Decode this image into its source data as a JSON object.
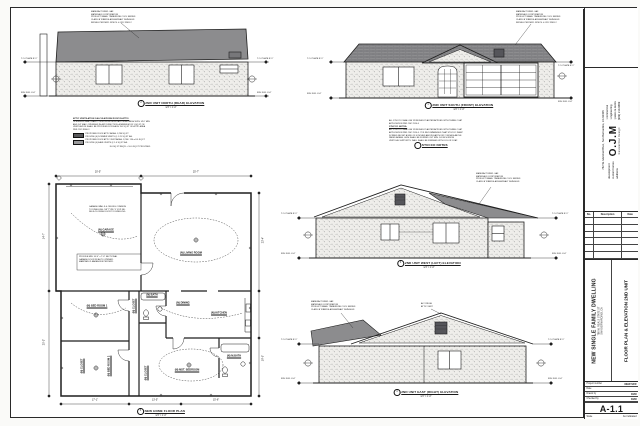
{
  "page": {
    "ink": "#1f1f1f",
    "roof_gray": "#8c8c8e",
    "vent_dark": "#55555a"
  },
  "titleblock": {
    "company": {
      "address_line": "782 W. Marshall Blvd., San Bernardino, CA 92405",
      "dev1": "development",
      "dev2": "custom homes",
      "dev3": "additions",
      "logo": "O.J.M",
      "logo_sub": "Residential Design",
      "svc1": ": commercial",
      "svc2": ": engineering",
      "svc3": ": patios & decks",
      "phone": "(909) 210-9669"
    },
    "revisions": {
      "no": "No.",
      "description": "Description",
      "date": "Date"
    },
    "project": {
      "title": "NEW SINGLE FAMILY DWELLING",
      "addr1": "786 W. REALS STATE ST",
      "addr2": "SAN BERNARDINO, CA",
      "sheet_title": "FLOOR PLAN & ELEVATION 2ND UNIT"
    },
    "fields": {
      "pn_label": "Project number",
      "pn_value": "NEW SFR",
      "date_label": "Date",
      "date_value": "",
      "drawn_label": "Drawn by",
      "drawn_value": "OJM",
      "checked_label": "Checked by",
      "checked_value": "OJM",
      "sheet_number": "A-1.1",
      "scale_label": "Scale",
      "scale_value": "As indicated"
    }
  },
  "callouts": {
    "front": {
      "num": "1",
      "title": "2ND UNIT SOUTH (FRONT) ELEVATION",
      "scale": "1/4\" = 1'-0\""
    },
    "north": {
      "num": "2",
      "title": "2ND UNIT NORTH (REAR) ELEVATION",
      "scale": "1/4\" = 1'-0\""
    },
    "west": {
      "num": "3",
      "title": "2ND UNIT WEST (LEFT) ELEVATION",
      "scale": "1/4\" = 1'-0\""
    },
    "east": {
      "num": "4",
      "title": "2ND UNIT EAST (RIGHT) ELEVATION",
      "scale": "1/4\" = 1'-0\""
    },
    "plan": {
      "num": "5",
      "title": "NEW HOME FLOOR PLAN",
      "scale": "1/4\" = 1'-0\""
    }
  },
  "elev_marks": {
    "top_plate": "T.O. PLATE 8'-1\"",
    "floor": "FIN. FLR. 0'-0\""
  },
  "rooms": {
    "garage": "(N) GARAGE",
    "living": "(N) LIVING ROOM",
    "dining": "(N) DINING",
    "kitchen": "(N) KITCHEN",
    "bath": "(N) BATH",
    "closet": "(N) CLOSET",
    "bed1": "(N) BED ROOM 1",
    "bed2": "(N) BED ROOM 2",
    "master": "(N) MST. BEDROOM",
    "mbath": "(N) M.BATH"
  },
  "plan_dims": {
    "top1": "20'-5\"",
    "top2": "25'-7\"",
    "left1": "14'-7\"",
    "left2": "25'-3\"",
    "bottom1": "17'-1\"",
    "bottom2": "13'-5\"",
    "bottom3": "15'-6\"",
    "right1": "23'-4\"",
    "right2": "19'-5\""
  },
  "notes": {
    "mfr": {
      "l1": "MANUFACTURER: GAF",
      "l2": "MATERIALS CORPORATION",
      "l3": "PRODUCT NAME: TIMBERLINE COOL SERIES",
      "l4": "CLASS 'A' FIBERGLASS ASPHALT SHINGLES",
      "l5": "INSTALL PER MFR. SPECS. & CRC R905.2"
    },
    "attic": {
      "title": "ATTIC VENTILATION CALCULATIONS ROOF IN ATTIC:",
      "l1": "OPENINGS SHALL HAVE CORROSION RESISTANT WIRE MESH WITH 1/16\" MIN.",
      "l2": "AND 1/4\" MAX. OPENINGS IN ANY DIRECTION. A MINIMUM OF 1 SQ FT OF",
      "l3": "VENTILATION SHALL BE PROVIDED FOR EACH 150 SQ FT OF ATTIC AREA",
      "l4": "PER CRC R806.2.",
      "leg1a": "PROPOSED ROOF ATTIC AREA: 1,290 SQ FT",
      "leg1b": "PROVIDE (6) DORMER VENTS @ 1.25 SQ FT EA.",
      "leg2a": "PROPOSED ROOF ATTIC VENT AREA: 1,290 / 150 = 8.6 SQ FT",
      "leg2b": "PROVIDE (4) EAVE VENTS @ 1.0 SQ FT EA.",
      "footer": "8.6 SQ FT REQ'D < 10.0 SQ FT PROVIDED"
    },
    "stucco": {
      "i1": "ALL STUCCO SHALL BE 7/8 INCHES PLASTER APPLIED WITH THREE COAT",
      "i2": "APPLICATION PER CBC 2510.6",
      "head": "STUCCO NOTES:",
      "l1": "ALL STUCCO SHALL BE 7/8 INCHES PLASTER APPLIED WITH THREE COAT",
      "l2": "APPLICATION PER CBC 2510.6. IT IS RECOMMENDED THAT STUCCO WEEP",
      "l3": "SCREED BE SET A MIN. OF 4 INCHES ABOVE EARTH OR 2 INCHES ABOVE",
      "l4": "PAVED AREAS. LATH SHALL BE FURRED OUT MIN. 1/4 INCH FROM",
      "l5": "VERTICAL SUPPORTS. WALL SHALL BE FINISHED WITH COLOR COAT.",
      "callout": "STUCCO NOTES"
    },
    "garage_box": {
      "l1": "PROVIDE MIN. 16'-0\" x 7'-0\" SECTIONAL",
      "l2": "GARAGE DOOR W/ AUTO OPENER.",
      "l3": "MAINTAIN CLEARANCES PER MFR."
    },
    "garage2": {
      "l1": "GARAGE WALLS & CEILING COMMON",
      "l2": "TO DWELLING: 5/8\" TYPE 'X' GYP. BD.",
      "l3": "SELF-CLOSING DOOR TO DWELLING"
    },
    "east_small": {
      "l1": "ALT. RIDGE",
      "l2": "ATTIC VENT"
    }
  }
}
